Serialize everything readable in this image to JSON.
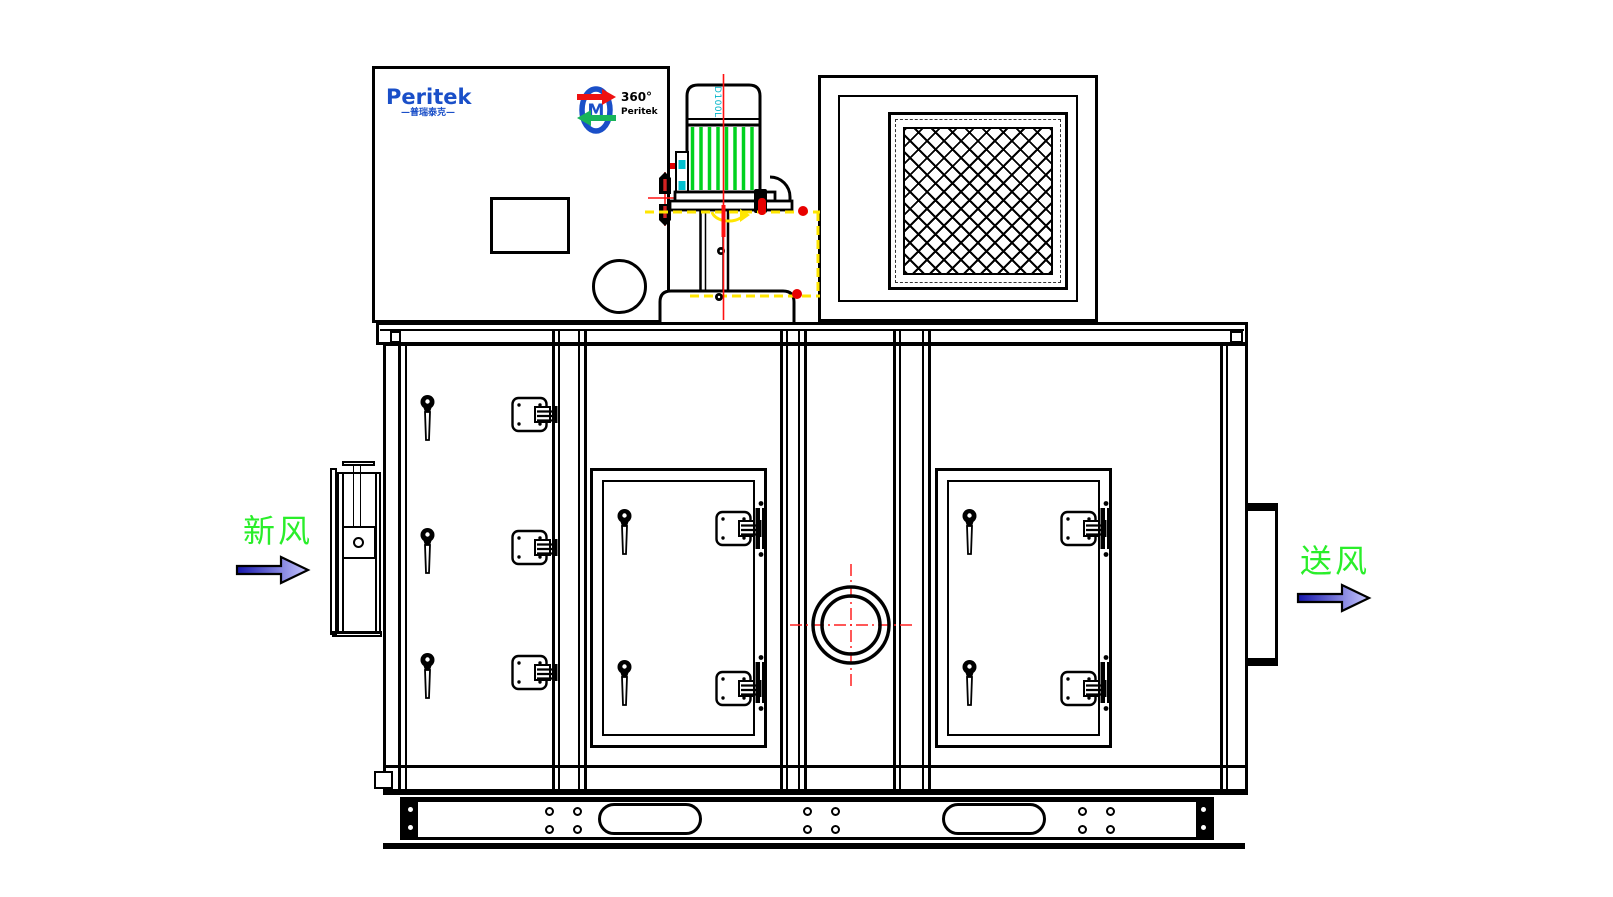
{
  "control_panel": {
    "brand": "Peritek",
    "brand_sub": "—普瑞泰克—"
  },
  "rotation_badge": {
    "glyph": "M",
    "degree": "360°",
    "brand": "Peritek"
  },
  "motor": {
    "model": "D100L"
  },
  "flow": {
    "inlet_label": "新风",
    "outlet_label": "送风"
  },
  "colors": {
    "line": "#000000",
    "centerline_red": "#ff1010",
    "highlight_yellow": "#ffe600",
    "motor_fin_green": "#00d21e",
    "flow_label_green": "#2aee2a",
    "accent_cyan": "#00c0d0",
    "brand_blue": "#1a4fc8",
    "badge_arrow_red": "#ee1111",
    "badge_arrow_green": "#18b45a",
    "arrow_fill_dark": "#1616ac",
    "arrow_fill_light": "#c8c8ff"
  }
}
